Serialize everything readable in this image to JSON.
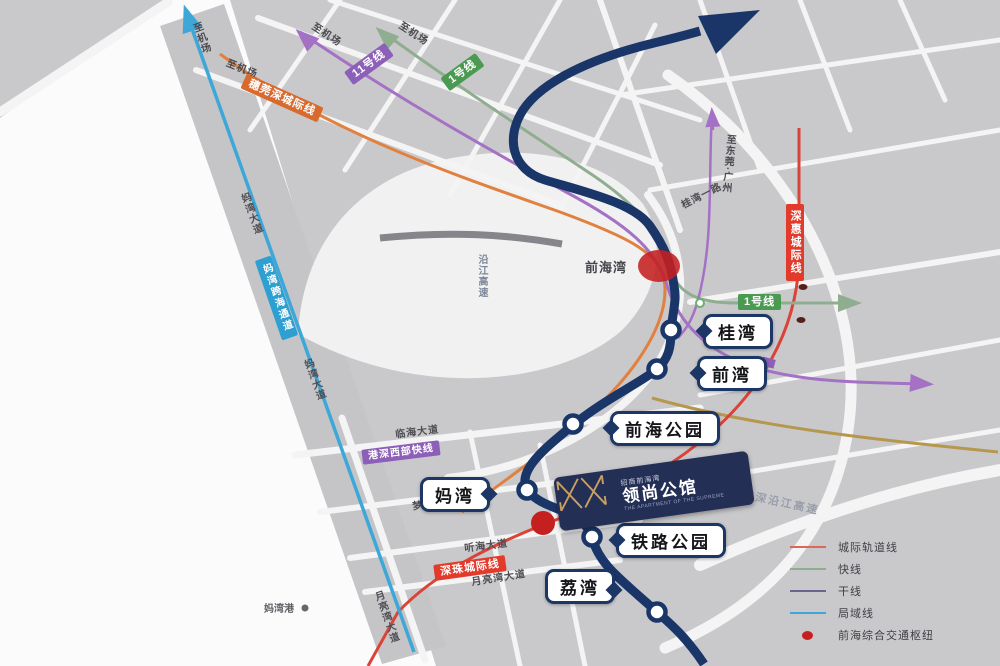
{
  "stations": [
    {
      "name": "桂湾"
    },
    {
      "name": "前湾"
    },
    {
      "name": "前海公园"
    },
    {
      "name": "妈湾"
    },
    {
      "name": "铁路公园"
    },
    {
      "name": "荔湾"
    }
  ],
  "places": {
    "qianhai_bay": "前海湾",
    "mawan_port": "妈湾港"
  },
  "line_badges": {
    "line11": "11号线",
    "line1_top": "1号线",
    "line1_right": "1号线",
    "suiwanshen": "穗莞深城际线",
    "shenhui": "深惠城际线",
    "shenzhu": "深珠城际线",
    "gangshen_west": "港深西部快线",
    "mawan_channel": "妈湾跨海通道"
  },
  "direction_labels": {
    "to_airport": "至机场",
    "to_dongguan_guangzhou": "至东莞·广州"
  },
  "roads": {
    "linhai_ave": "临海大道",
    "menghai_ave": "梦海大道",
    "tinghai_ave": "听海大道",
    "moonbay_ave": "月亮湾大道",
    "mawan_ave": "妈湾大道",
    "guiwan_rd": "桂湾一路",
    "yanjiang_expwy": "沿江高速",
    "guangshen_yanjiang_expwy": "广深沿江高速"
  },
  "legend": {
    "items": [
      {
        "label": "城际轨道线",
        "color": "#d96a5a"
      },
      {
        "label": "快线",
        "color": "#8fae8f"
      },
      {
        "label": "干线",
        "color": "#6b6390"
      },
      {
        "label": "局域线",
        "color": "#3da8d8"
      },
      {
        "label": "前海综合交通枢纽",
        "color": "#c42020"
      }
    ]
  },
  "logo": {
    "brand": "招商前海湾",
    "name": "领尚公馆",
    "subtitle": "THE APARTMENT OF THE SUPREME"
  },
  "colors": {
    "main_line_navy": "#1a3668",
    "local_line_cyan": "#3da8d8",
    "intercity_red": "#da4438",
    "intercity_orange": "#e0813f",
    "express_green": "#8fae8f",
    "trunk_purple": "#a471c4",
    "hub_red": "#c42020"
  }
}
